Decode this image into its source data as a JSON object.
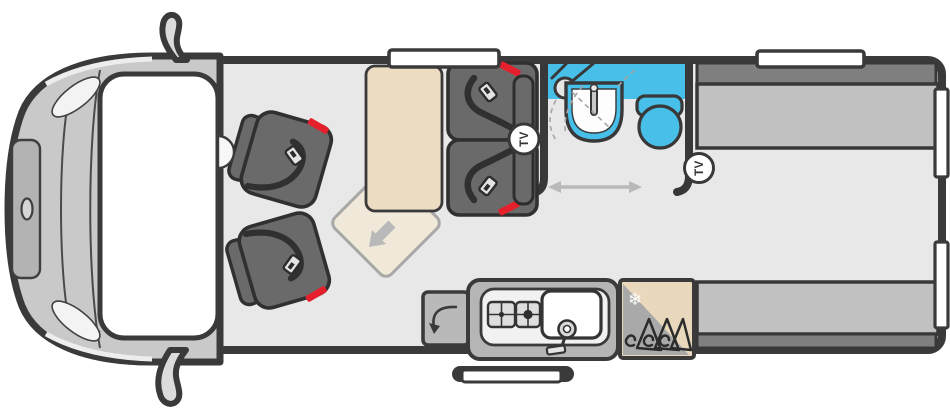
{
  "floorplan": {
    "labels": {
      "tv_front": "TV",
      "tv_rear": "TV"
    },
    "icons": {
      "snowflake_glyph": "❄"
    },
    "colors": {
      "wall_outline": "#3a3a3a",
      "floor": "#e8e8e8",
      "wet_room_blue": "#47bfe9",
      "seat_upholstery": "#6a6a6a",
      "rear_bench_cushion": "#c1c1c1",
      "rear_bench_backrest": "#7f7f7f",
      "table_beige": "#ecdcc2",
      "worktop_gray": "#b5b5b5",
      "fridge_beige": "#e9d8bb",
      "seatbelt_red": "#e4202c",
      "window_white": "#ffffff",
      "arrow_gray": "#b9b9b9"
    }
  }
}
